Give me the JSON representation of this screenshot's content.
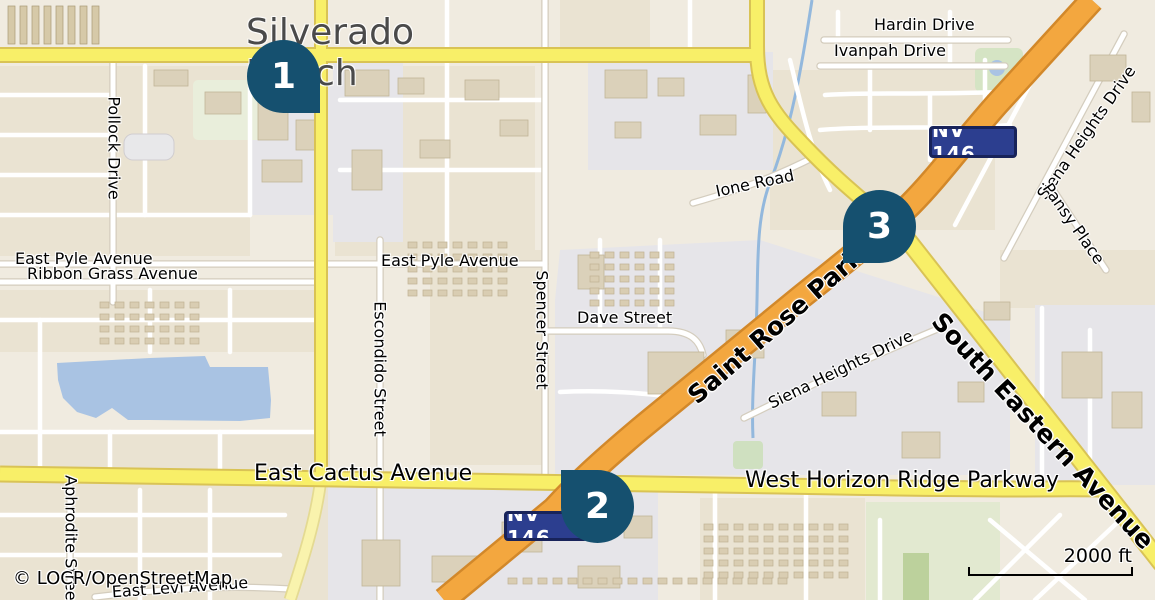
{
  "map": {
    "title": "Silverado Ranch",
    "attribution": "© LOCR/OpenStreetMap",
    "scale": {
      "label": "2000 ft"
    },
    "markers": [
      {
        "number": "1"
      },
      {
        "number": "2"
      },
      {
        "number": "3"
      }
    ],
    "shields": [
      {
        "label": "NV 146"
      },
      {
        "label": "NV 146"
      }
    ],
    "labels": {
      "pollock": "Pollock Drive",
      "pyle_left": "East Pyle Avenue",
      "ribbon": "Ribbon Grass Avenue",
      "pyle_mid": "East Pyle Avenue",
      "dave": "Dave Street",
      "spencer": "Spencer Street",
      "escondido": "Escondido Street",
      "cactus": "East Cactus Avenue",
      "horizon": "West Horizon Ridge Parkway",
      "aphrodite": "Aphrodite Street",
      "levi": "East Levi Avenue",
      "hardin": "Hardin Drive",
      "ivanpah": "Ivanpah Drive",
      "ione": "Ione Road",
      "siena_top": "Siena Heights Drive",
      "pansy": "Pansy Place",
      "siena_mid": "Siena Heights Drive",
      "saint_rose": "Saint Rose Parkway",
      "south_eastern": "South Eastern Avenue"
    },
    "colors": {
      "color-pin": "#15506f",
      "color-shield": "#2c3e8f",
      "color-shield-border": "#18235a",
      "color-water": "#a9c3e3",
      "color-primary-road": "#f3a73f",
      "color-primary-casing": "#d2882a",
      "color-secondary-road": "#f8ef68",
      "color-secondary-casing": "#d9c355",
      "color-title": "#4a4a4a"
    }
  }
}
